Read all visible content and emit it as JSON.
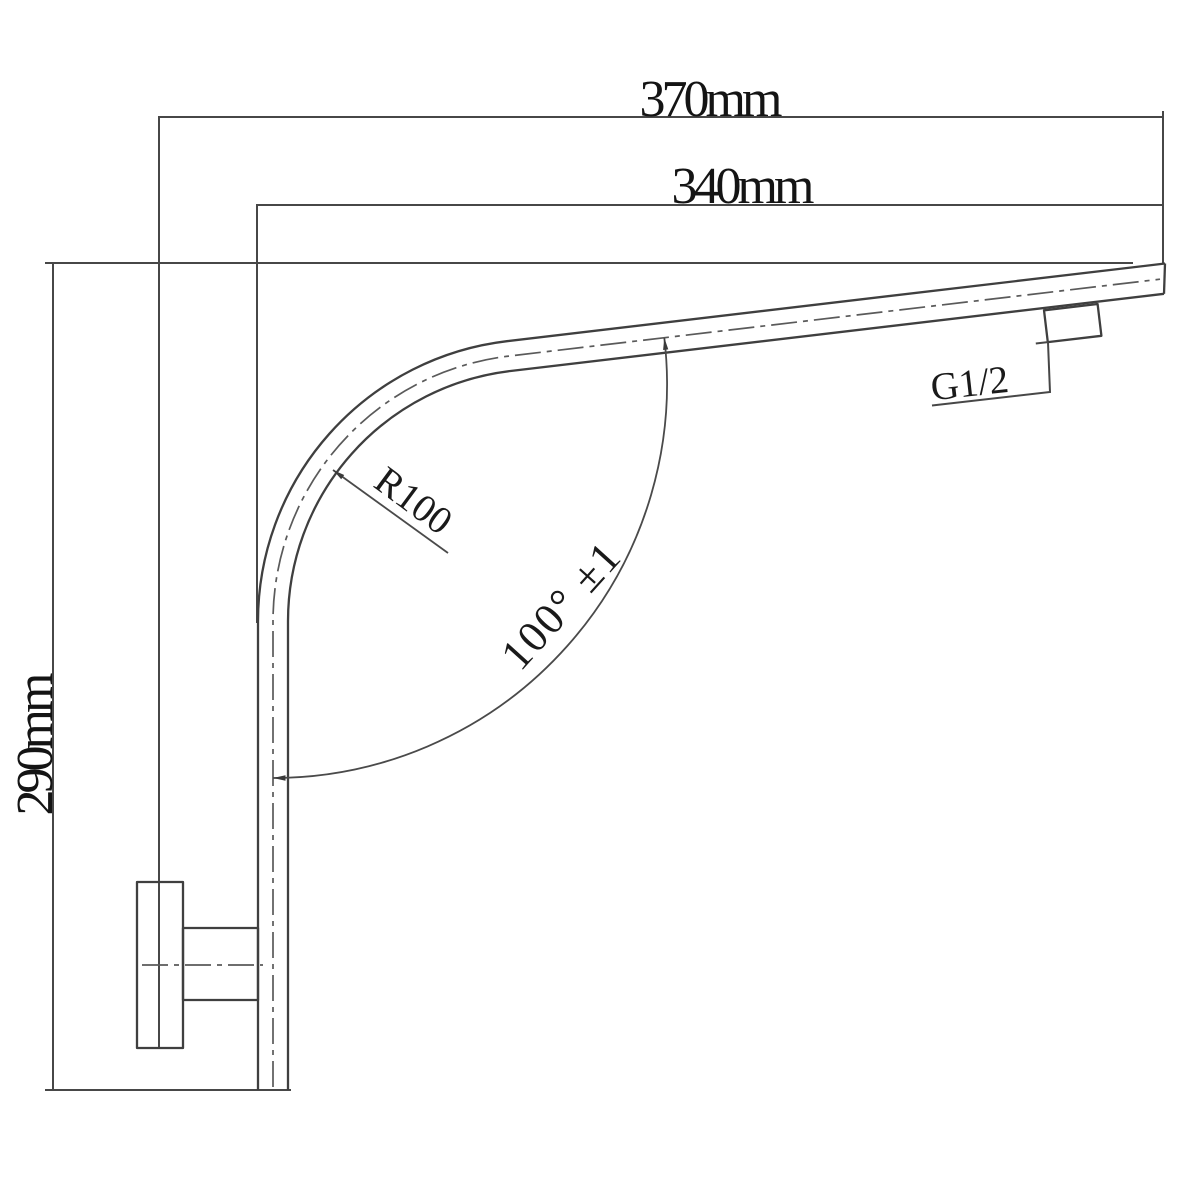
{
  "title": "Shower arm technical dimension drawing",
  "colors": {
    "background": "#ffffff",
    "line": "#474747",
    "pipe_line": "#3f3f3f",
    "text": "#141414"
  },
  "labels": {
    "width_overall": "370mm",
    "width_arm": "340mm",
    "height_overall": "290mm",
    "bend_radius": "R100",
    "bend_angle": "100° ±1",
    "thread": "G1/2"
  }
}
